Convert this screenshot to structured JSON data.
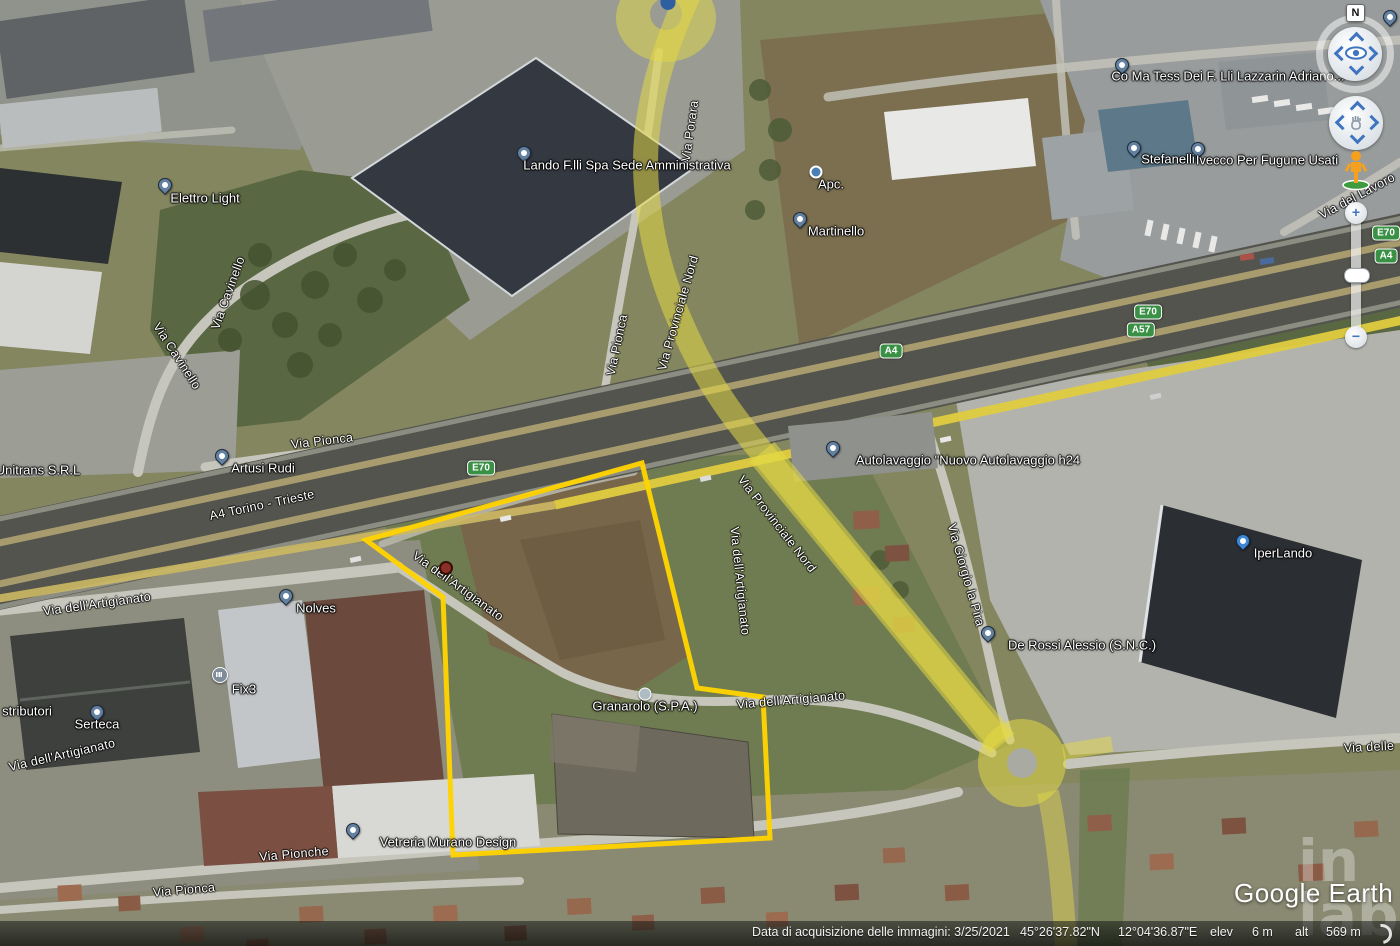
{
  "map": {
    "place_labels": [
      {
        "text": "Elettro Light",
        "x": 205,
        "y": 198,
        "marker": "pin",
        "mx": 165,
        "my": 192
      },
      {
        "text": "Lando F.lli Spa Sede Amministrativa",
        "x": 627,
        "y": 165,
        "marker": "pin",
        "mx": 524,
        "my": 160
      },
      {
        "text": "Apc.",
        "x": 831,
        "y": 184,
        "marker": "dot",
        "mx": 816,
        "my": 172
      },
      {
        "text": "Martinello",
        "x": 836,
        "y": 231,
        "marker": "pin",
        "mx": 800,
        "my": 226
      },
      {
        "text": "Co Ma Tess Dei F. Lli Lazzarin Adriano...",
        "x": 1228,
        "y": 76,
        "marker": "pin",
        "mx": 1122,
        "my": 72
      },
      {
        "text": "Stefanelli",
        "x": 1168,
        "y": 159,
        "marker": "pin",
        "mx": 1134,
        "my": 155
      },
      {
        "text": "Ivecco Per Fugune Usati",
        "x": 1267,
        "y": 160,
        "marker": "pin",
        "mx": 1198,
        "my": 156
      },
      {
        "text": "Artusi Rudi",
        "x": 263,
        "y": 468,
        "marker": "pin",
        "mx": 222,
        "my": 463
      },
      {
        "text": "Unitrans S.R.L",
        "x": 38,
        "y": 470,
        "marker": "none"
      },
      {
        "text": "Autolavaggio \"Nuovo Autolavaggio h24",
        "x": 968,
        "y": 460,
        "marker": "pin",
        "mx": 833,
        "my": 455
      },
      {
        "text": "Nolves",
        "x": 316,
        "y": 608,
        "marker": "pin",
        "mx": 286,
        "my": 603
      },
      {
        "text": "Fix3",
        "x": 244,
        "y": 689,
        "marker": "bank",
        "mx": 220,
        "my": 675
      },
      {
        "text": "stributori",
        "x": 27,
        "y": 711,
        "marker": "none"
      },
      {
        "text": "Serteca",
        "x": 97,
        "y": 724,
        "marker": "pin",
        "mx": 97,
        "my": 719
      },
      {
        "text": "De Rossi Alessio (S.N.C.)",
        "x": 1082,
        "y": 645,
        "marker": "pin",
        "mx": 988,
        "my": 640
      },
      {
        "text": "IperLando",
        "x": 1283,
        "y": 553,
        "marker": "cart",
        "mx": 1243,
        "my": 548
      },
      {
        "text": "Granarolo (S.P.A.)",
        "x": 645,
        "y": 706,
        "marker": "dot-gray",
        "mx": 645,
        "my": 694
      },
      {
        "text": "Vetreria Murano Design",
        "x": 448,
        "y": 842,
        "marker": "pin",
        "mx": 353,
        "my": 837
      }
    ],
    "road_labels": [
      {
        "text": "Via Cavinello",
        "x": 228,
        "y": 293,
        "r": -70
      },
      {
        "text": "Via Cavinello",
        "x": 177,
        "y": 356,
        "r": 57
      },
      {
        "text": "Via Pionca",
        "x": 617,
        "y": 345,
        "r": -78
      },
      {
        "text": "Via Provinciale Nord",
        "x": 678,
        "y": 313,
        "r": -74
      },
      {
        "text": "Via Porara",
        "x": 690,
        "y": 131,
        "r": -82
      },
      {
        "text": "Via Pionca",
        "x": 322,
        "y": 441,
        "r": -7
      },
      {
        "text": "A4 Torino - Trieste",
        "x": 262,
        "y": 505,
        "r": -12
      },
      {
        "text": "Via dell'Artigianato",
        "x": 97,
        "y": 604,
        "r": -8
      },
      {
        "text": "Via dell'Artigianato",
        "x": 62,
        "y": 755,
        "r": -13
      },
      {
        "text": "Via dell'Artigianato",
        "x": 458,
        "y": 586,
        "r": 36
      },
      {
        "text": "Via dell'Artigianato",
        "x": 740,
        "y": 581,
        "r": 84
      },
      {
        "text": "Via Provinciale Nord",
        "x": 777,
        "y": 524,
        "r": 52
      },
      {
        "text": "Via dell'Artigianato",
        "x": 791,
        "y": 700,
        "r": -5
      },
      {
        "text": "Via Giorgio la Pira",
        "x": 966,
        "y": 575,
        "r": 74
      },
      {
        "text": "Via delle",
        "x": 1369,
        "y": 747,
        "r": -3
      },
      {
        "text": "Via Pionche",
        "x": 294,
        "y": 854,
        "r": -5
      },
      {
        "text": "Via Pionca",
        "x": 184,
        "y": 890,
        "r": -5
      },
      {
        "text": "Via del Lavoro",
        "x": 1357,
        "y": 196,
        "r": -28
      }
    ],
    "shields": [
      {
        "text": "E70",
        "x": 481,
        "y": 468
      },
      {
        "text": "A4",
        "x": 891,
        "y": 351
      },
      {
        "text": "E70",
        "x": 1148,
        "y": 312
      },
      {
        "text": "A57",
        "x": 1141,
        "y": 330
      },
      {
        "text": "E70",
        "x": 1386,
        "y": 233
      },
      {
        "text": "A4",
        "x": 1386,
        "y": 256
      }
    ],
    "extra_markers": [
      {
        "type": "red-dot",
        "x": 446,
        "y": 568
      },
      {
        "type": "half-pin",
        "x": 668,
        "y": 0
      },
      {
        "type": "pin",
        "x": 1390,
        "y": 24
      }
    ]
  },
  "controls": {
    "compass_north": "N",
    "zoom_in_label": "+",
    "zoom_out_label": "−"
  },
  "status_bar": {
    "acquisition": "Data di acquisizione delle immagini: 3/25/2021",
    "latitude": "45°26'37.82\"N",
    "longitude": "12°04'36.87\"E",
    "elev_label": "elev",
    "elev_value": "6 m",
    "alt_label": "alt",
    "alt_value": "569 m"
  },
  "branding": {
    "logo_text": "Google Earth",
    "watermark_top": "in",
    "watermark_bottom": "lab"
  }
}
